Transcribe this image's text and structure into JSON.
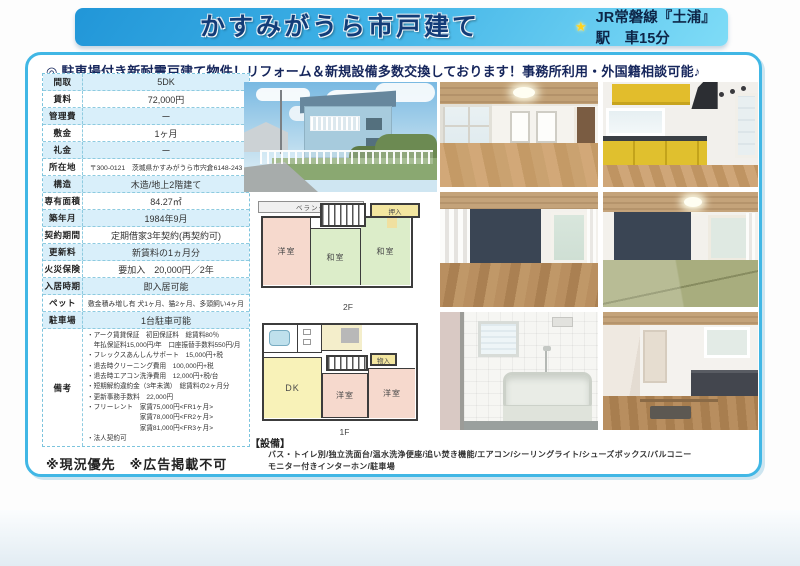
{
  "header": {
    "title": "かすみがうら市戸建て",
    "star_icon": "★",
    "station_info": "JR常磐線『土浦』駅　車15分"
  },
  "catchcopy": "◎ 駐車場付き新耐震戸建て物件！リフォーム＆新規設備多数交換しております！事務所利用・外国籍相談可能♪",
  "colors": {
    "banner_gradient_start": "#2196d8",
    "banner_gradient_end": "#7fdcf7",
    "box_border": "#41b7e5",
    "row_tint": "#d9effa",
    "title_color": "#123c78"
  },
  "table": {
    "rows": [
      {
        "label": "間取",
        "value": "5DK"
      },
      {
        "label": "賃料",
        "value": "72,000円"
      },
      {
        "label": "管理費",
        "value": "ー"
      },
      {
        "label": "敷金",
        "value": "1ヶ月"
      },
      {
        "label": "礼金",
        "value": "ー"
      },
      {
        "label": "所在地",
        "value": "〒300-0121　茨城県かすみがうら市宍倉6148-243"
      },
      {
        "label": "構造",
        "value": "木造/地上2階建て"
      },
      {
        "label": "専有面積",
        "value": "84.27㎡"
      },
      {
        "label": "築年月",
        "value": "1984年9月"
      },
      {
        "label": "契約期間",
        "value": "定期借家3年契約(再契約可)"
      },
      {
        "label": "更新料",
        "value": "新賃料の1ヵ月分"
      },
      {
        "label": "火災保険",
        "value": "要加入　20,000円／2年"
      },
      {
        "label": "入居時期",
        "value": "即入居可能"
      },
      {
        "label": "ペット",
        "value": "敷金積み増し有 犬1ヶ月、猫2ヶ月、多頭飼い4ヶ月"
      },
      {
        "label": "駐車場",
        "value": "1台駐車可能"
      }
    ],
    "remarks_label": "備考",
    "remarks_lines": [
      "・アーク賃貸保証　初回保証料　総賃料80％",
      "　年払保証料15,000円/年　口座振替手数料550円/月",
      "・フレックスあんしんサポート　15,000円+税",
      "・退去時クリーニング費用　100,000円+税",
      "・退去時エアコン洗浄費用　12,000円+税/台",
      "・短期解約違約金（3年未満）　総賃料の2ヶ月分",
      "・更新事務手数料　22,000円",
      "・フリーレント　家賃75,000円<FR1ヶ月>",
      "　　　　　　　　家賃78,000円<FR2ヶ月>",
      "　　　　　　　　家賃81,000円<FR3ヶ月>",
      "・法人契約可"
    ]
  },
  "footer_notes": "※現況優先　※広告掲載不可",
  "equipment": {
    "label": "【設備】",
    "line1": "バス・トイレ別/独立洗面台/温水洗浄便座/追い焚き機能/エアコン/シーリングライト/シューズボックス/バルコニー",
    "line2": "モニター付きインターホン/駐車場"
  },
  "floorplans": {
    "second": {
      "label": "2F",
      "western": "洋室",
      "japanese1": "和室",
      "japanese2": "和室",
      "closet": "押入",
      "veranda": "ベランダ"
    },
    "first": {
      "label": "1F",
      "dk": "DK",
      "western1": "洋室",
      "western2": "洋室",
      "storage": "物入"
    }
  }
}
